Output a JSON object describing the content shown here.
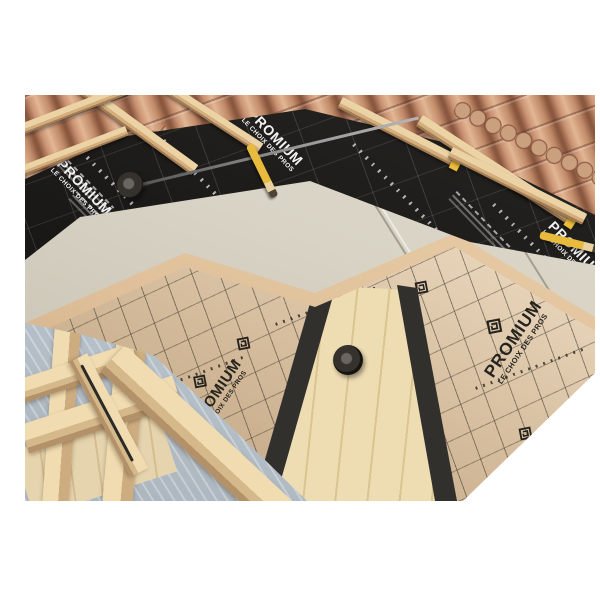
{
  "branding": {
    "product_name": "PROMIUM",
    "tagline": "LE CHOIX DES PROS",
    "roll_marking": "180"
  },
  "fragments": {
    "letter_m": "M",
    "number_80": "80"
  },
  "colors": {
    "background": "#ffffff",
    "underlay_membrane_black": "#1d1c1a",
    "underlay_print_white": "#f2f2f2",
    "kraft_membrane": "#e5d2ba",
    "kraft_print_black": "#26231e",
    "insulation_board_grey_beige": "#d8d3c5",
    "fiberboard_tan": "#e2c69e",
    "wood_light": "#ead5a9",
    "roof_tile_terracotta": "#c08a68",
    "adhesive_tape_black": "#32302d",
    "between_joist_panel_blue": "#bdc7d0",
    "pencil_yellow": "#e8bb3c",
    "batten_end_tab_yellow": "#ecbc3a"
  }
}
